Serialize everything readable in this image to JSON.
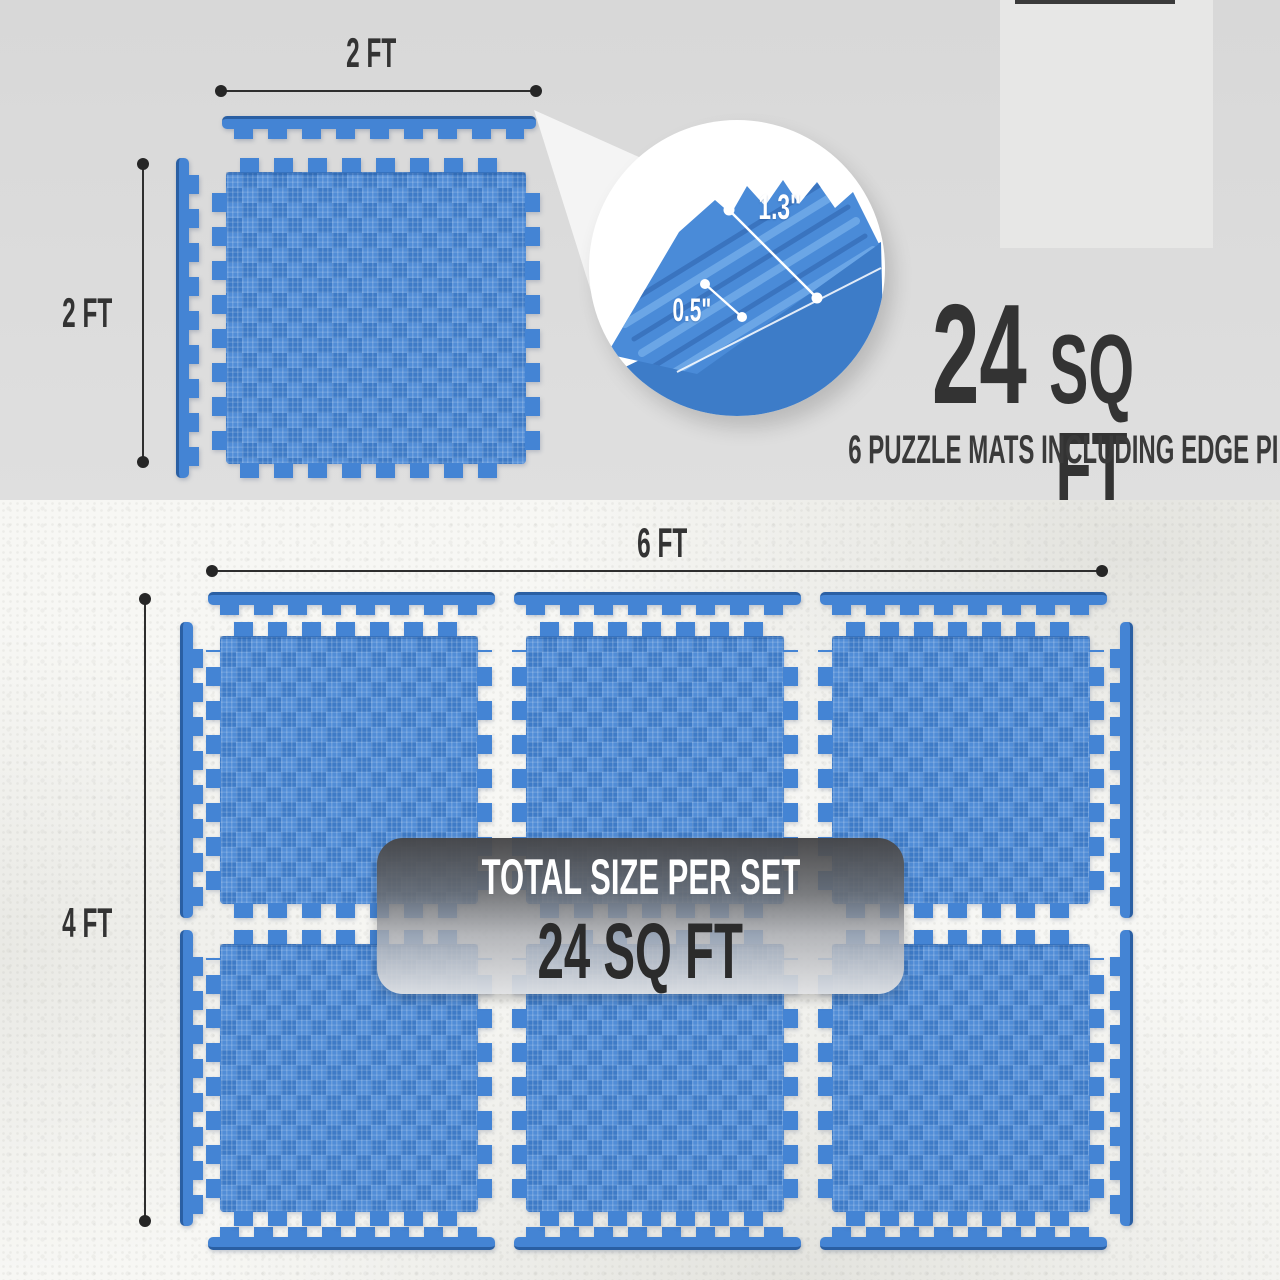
{
  "top_panel": {
    "width_label": "2 FT",
    "height_label": "2 FT",
    "thickness_callout": {
      "ridge_thickness": "1.3\"",
      "base_thickness": "0.5\""
    },
    "headline": {
      "number": "24",
      "unit": "SQ FT"
    },
    "subheadline": "6 PUZZLE MATS INCLUDING EDGE PIECES"
  },
  "bottom_panel": {
    "width_label": "6 FT",
    "height_label": "4 FT",
    "banner": {
      "title": "TOTAL SIZE PER SET",
      "value": "24 SQ FT"
    }
  },
  "colors": {
    "mat_blue": "#4484d4",
    "mat_blue_dark_edge": "#2a5fa3",
    "mat_ridge_highlight": "#6ba6e6",
    "text_dark": "#333333",
    "panel_top_bg": "#dcdcdc",
    "panel_bottom_bg": "#f7f7f4",
    "banner_gradient_top": "#464648",
    "banner_gradient_bottom": "#e0e1e3",
    "callout_text": "#ffffff"
  }
}
